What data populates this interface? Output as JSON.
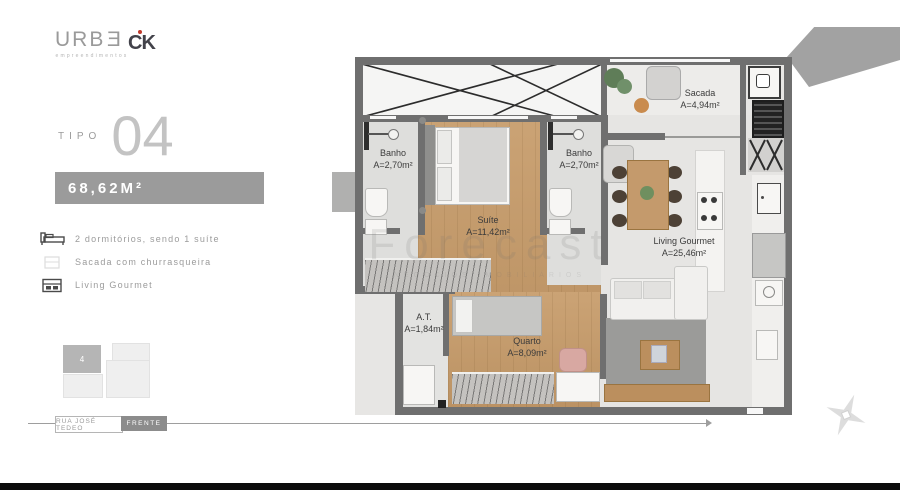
{
  "brand": {
    "urbe_prefix": "URB",
    "urbe_last": "E",
    "urbe_sub": "empreendimentos",
    "ck": "CK"
  },
  "unit": {
    "tipo_label": "TIPO",
    "tipo_number": "04",
    "area_badge": "68,62M²"
  },
  "features": [
    {
      "icon": "bed-icon",
      "label": "2 dormitórios, sendo 1 suíte"
    },
    {
      "icon": "balcony-grill-icon",
      "label": "Sacada com churrasqueira"
    },
    {
      "icon": "gourmet-cabinet-icon",
      "label": "Living Gourmet"
    }
  ],
  "siteplan": {
    "unit_label": "4"
  },
  "street": {
    "name": "RUA JOSÉ TEDEO",
    "front": "FRENTE"
  },
  "rooms": {
    "sacada": {
      "name": "Sacada",
      "area": "A=4,94m²"
    },
    "banho_left": {
      "name": "Banho",
      "area": "A=2,70m²"
    },
    "banho_right": {
      "name": "Banho",
      "area": "A=2,70m²"
    },
    "suite": {
      "name": "Suíte",
      "area": "A=11,42m²"
    },
    "living": {
      "name": "Living Gourmet",
      "area": "A=25,46m²"
    },
    "at": {
      "name": "A.T.",
      "area": "A=1,84m²"
    },
    "quarto": {
      "name": "Quarto",
      "area": "A=8,09m²"
    }
  },
  "watermark": {
    "title": "Forecast",
    "subtitle": "NEGÓCIOS IMOBILIÁRIOS"
  },
  "colors": {
    "wall": "#6f6f6f",
    "wood": "#c9a172",
    "banner": "#9b9b9b",
    "brand_red": "#c0392b"
  }
}
